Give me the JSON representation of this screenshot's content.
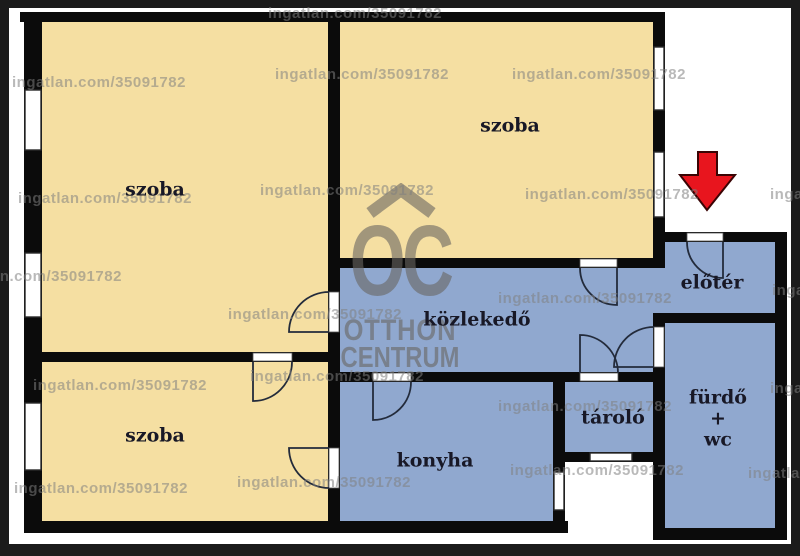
{
  "image_type": "apartment-floor-plan",
  "colors": {
    "frame": "#1B1B1B",
    "plan_background": "#FFFFFF",
    "wall": "#0B0B0B",
    "room_cream": "#F5DFA2",
    "room_blue": "#90A8CF",
    "window_fill": "#FFFFFF",
    "arrow_red": "#E8151E",
    "label_text": "#181826"
  },
  "watermark": {
    "text": "ingatlan.com/35091782",
    "instances": [
      [
        268,
        5
      ],
      [
        12,
        74
      ],
      [
        275,
        66
      ],
      [
        512,
        66
      ],
      [
        18,
        190
      ],
      [
        260,
        182
      ],
      [
        525,
        186
      ],
      [
        770,
        186
      ],
      [
        -52,
        268
      ],
      [
        228,
        306
      ],
      [
        498,
        290
      ],
      [
        772,
        282
      ],
      [
        33,
        377
      ],
      [
        250,
        368
      ],
      [
        498,
        398
      ],
      [
        770,
        380
      ],
      [
        14,
        480
      ],
      [
        237,
        474
      ],
      [
        510,
        462
      ],
      [
        748,
        465
      ]
    ]
  },
  "logo": {
    "monogram": "OC",
    "line1": "OTTHON",
    "line2": "CENTRUM"
  },
  "arrow": {
    "name": "entrance-arrow",
    "points": "698,152 717,152 717,175 735,175 707,210 680,175 698,175"
  },
  "rooms": [
    {
      "id": "szoba-top-left",
      "fill": "room_cream",
      "rect": [
        42,
        22,
        286,
        330
      ],
      "label_lines": [
        "szoba"
      ],
      "cx": 155,
      "cy": 190
    },
    {
      "id": "szoba-top-right",
      "fill": "room_cream",
      "rect": [
        340,
        22,
        313,
        236
      ],
      "label_lines": [
        "szoba"
      ],
      "cx": 510,
      "cy": 126
    },
    {
      "id": "szoba-bottom-left",
      "fill": "room_cream",
      "rect": [
        42,
        362,
        286,
        159
      ],
      "label_lines": [
        "szoba"
      ],
      "cx": 155,
      "cy": 436
    },
    {
      "id": "kozlekedo",
      "fill": "room_blue",
      "rect": [
        340,
        268,
        313,
        104
      ],
      "label_lines": [
        "közlekedő"
      ],
      "cx": 477,
      "cy": 320
    },
    {
      "id": "kozlekedo-passage",
      "fill": "room_blue",
      "rect": [
        653,
        268,
        12,
        45
      ],
      "label_lines": [],
      "cx": 0,
      "cy": 0
    },
    {
      "id": "konyha",
      "fill": "room_blue",
      "rect": [
        340,
        382,
        213,
        139
      ],
      "label_lines": [
        "konyha"
      ],
      "cx": 435,
      "cy": 461
    },
    {
      "id": "tarolo",
      "fill": "room_blue",
      "rect": [
        565,
        382,
        88,
        70
      ],
      "label_lines": [
        "tároló"
      ],
      "cx": 613,
      "cy": 418
    },
    {
      "id": "eloter",
      "fill": "room_blue",
      "rect": [
        665,
        242,
        110,
        71
      ],
      "label_lines": [
        "előtér"
      ],
      "cx": 712,
      "cy": 283
    },
    {
      "id": "furdo-wc",
      "fill": "room_blue",
      "rect": [
        665,
        323,
        110,
        205
      ],
      "label_lines": [
        "fürdő",
        "+",
        "wc"
      ],
      "cx": 718,
      "cy": 419
    }
  ],
  "geometry": {
    "plan_area": [
      9,
      8,
      782,
      536
    ],
    "walls": [
      [
        20,
        12,
        645,
        10
      ],
      [
        24,
        12,
        18,
        521
      ],
      [
        24,
        521,
        544,
        12
      ],
      [
        24,
        352,
        316,
        10
      ],
      [
        328,
        12,
        12,
        521
      ],
      [
        328,
        258,
        337,
        10
      ],
      [
        653,
        12,
        12,
        256
      ],
      [
        328,
        372,
        337,
        10
      ],
      [
        553,
        372,
        12,
        161
      ],
      [
        553,
        452,
        112,
        10
      ],
      [
        653,
        313,
        12,
        227
      ],
      [
        653,
        313,
        134,
        10
      ],
      [
        653,
        232,
        134,
        10
      ],
      [
        775,
        232,
        12,
        308
      ],
      [
        653,
        528,
        134,
        12
      ]
    ],
    "windows": [
      [
        25,
        90,
        16,
        60
      ],
      [
        25,
        253,
        16,
        64
      ],
      [
        25,
        403,
        16,
        67
      ],
      [
        654,
        47,
        10,
        63
      ],
      [
        654,
        152,
        10,
        65
      ],
      [
        554,
        472,
        10,
        38
      ],
      [
        590,
        453,
        42,
        8
      ]
    ],
    "door_gaps": [
      [
        329,
        292,
        10,
        40
      ],
      [
        253,
        353,
        39,
        8
      ],
      [
        329,
        448,
        10,
        40
      ],
      [
        580,
        259,
        37,
        8
      ],
      [
        580,
        373,
        38,
        8
      ],
      [
        373,
        373,
        38,
        8
      ],
      [
        654,
        327,
        10,
        40
      ],
      [
        687,
        233,
        36,
        8
      ]
    ],
    "door_arcs": [
      "M 329 332 L 289 332 A 40 40 0 0 1 329 292",
      "M 253 362 L 253 401 A 39 39 0 0 0 292 362",
      "M 329 448 L 289 448 A 40 40 0 0 0 329 488",
      "M 617 268 L 617 305 A 37 37 0 0 1 580 268",
      "M 580 373 L 580 335 A 38 38 0 0 1 618 373",
      "M 373 382 L 373 420 A 38 38 0 0 0 411 382",
      "M 654 367 L 614 367 A 40 40 0 0 1 654 327",
      "M 723 242 L 723 278 A 36 36 0 0 1 687 242"
    ]
  }
}
